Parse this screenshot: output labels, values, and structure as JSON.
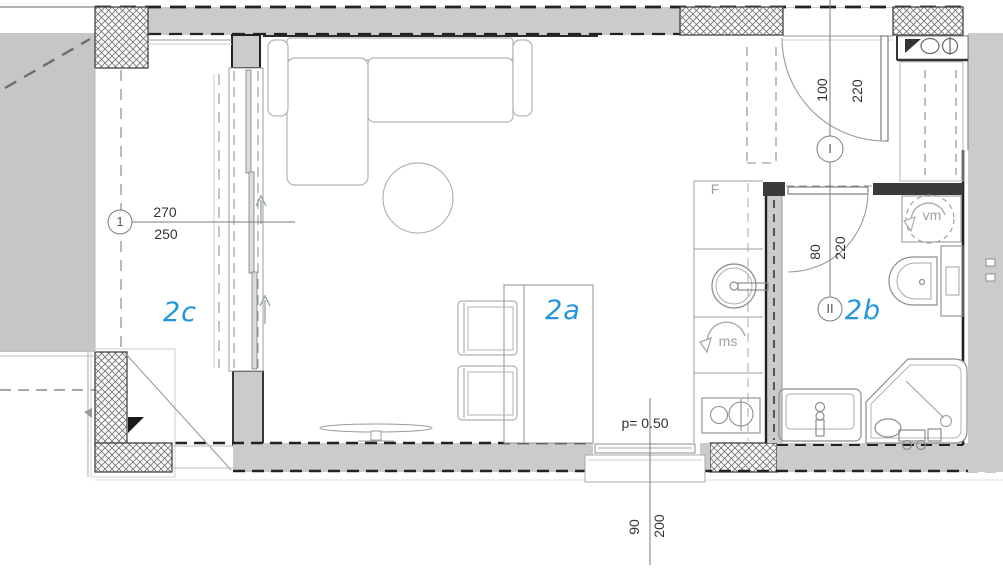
{
  "plan": {
    "title": "apartment-floor-plan",
    "room_labels": {
      "living": "2a",
      "bathroom": "2b",
      "loggia": "2c"
    },
    "markers": {
      "loggia_window": "1",
      "entrance_door": "I",
      "bathroom_door": "II"
    },
    "dimensions": {
      "loggia_window_width": "270",
      "loggia_window_height": "250",
      "entrance_door_width": "100",
      "entrance_door_height": "220",
      "bathroom_door_width": "80",
      "bathroom_door_height": "220",
      "bottom_window_width": "90",
      "bottom_window_height": "200",
      "parapet_height": "p= 0.50"
    },
    "appliance_labels": {
      "fridge": "F",
      "kitchen_unit": "ms",
      "washing_machine": "vm"
    },
    "colors": {
      "wall_fill": "#cbcbcb",
      "balcony_fill": "#c6c6c6",
      "accent_blue": "#2395dd",
      "line_dark": "#222222",
      "line_gray": "#999999"
    }
  }
}
